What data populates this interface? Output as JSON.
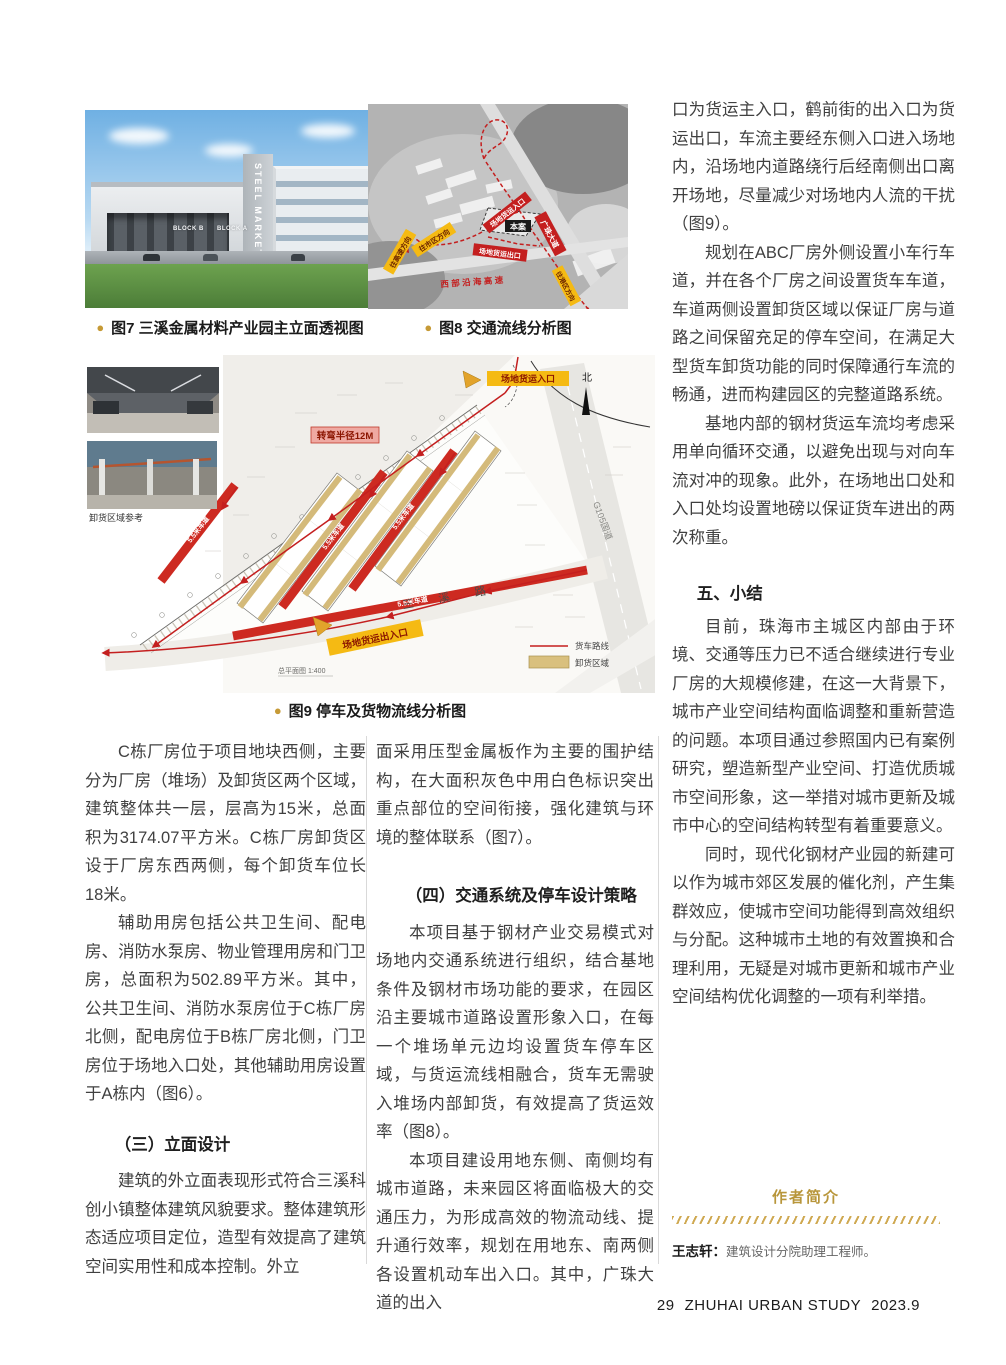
{
  "page": {
    "footer": {
      "page_number": "29",
      "journal_title": "ZHUHAI URBAN STUDY",
      "issue": "2023.9"
    }
  },
  "figures": {
    "fig7": {
      "caption": "图7 三溪金属材料产业园主立面透视图",
      "sign_vertical": "STEEL MARKET",
      "block_a_label": "BLOCK A",
      "block_b_label": "BLOCK B"
    },
    "fig8": {
      "caption": "图8 交通流线分析图",
      "labels": {
        "freight_entrance": "场地货运入口",
        "site": "本案",
        "guangzhu_avenue": "广珠大道",
        "to_city": "往市区方向",
        "to_highway": "往高速方向",
        "freight_exit": "场地货运出口",
        "west_coastal_expressway": "西 部 沿 海 高 速",
        "to_port": "往港区方向"
      }
    },
    "fig9": {
      "caption": "图9 停车及货物流线分析图",
      "photos_caption": "卸货区域参考",
      "labels": {
        "turning_radius": "转弯半径12M",
        "freight_entrance": "场地货运入口",
        "freight_exit_entrance": "场地货运出入口",
        "north": "北",
        "g105": "G105国道",
        "sanxi_road": "三 溪 路",
        "lane": "5.5米车道",
        "scale_note": "总平面图 1:400"
      },
      "legend": {
        "truck_route": "货车路线",
        "unloading_area": "卸货区域"
      }
    }
  },
  "columns": {
    "left": {
      "p1": "C栋厂房位于项目地块西侧，主要分为厂房（堆场）及卸货区两个区域，建筑整体共一层，层高为15米，总面积为3174.07平方米。C栋厂房卸货区设于厂房东西两侧，每个卸货车位长18米。",
      "p2": "辅助用房包括公共卫生间、配电房、消防水泵房、物业管理用房和门卫房，总面积为502.89平方米。其中，公共卫生间、消防水泵房位于C栋厂房北侧，配电房位于B栋厂房北侧，门卫房位于场地入口处，其他辅助用房设置于A栋内（图6）。",
      "h1": "（三）立面设计",
      "p3": "建筑的外立面表现形式符合三溪科创小镇整体建筑风貌要求。整体建筑形态适应项目定位，造型有效提高了建筑空间实用性和成本控制。外立"
    },
    "middle": {
      "p1": "面采用压型金属板作为主要的围护结构，在大面积灰色中用白色标识突出重点部位的空间衔接，强化建筑与环境的整体联系（图7）。",
      "h1": "（四）交通系统及停车设计策略",
      "p2": "本项目基于钢材产业交易模式对场地内交通系统进行组织，结合基地条件及钢材市场功能的要求，在园区沿主要城市道路设置形象入口，在每一个堆场单元边均设置货车停车区域，与货运流线相融合，货车无需驶入堆场内部卸货，有效提高了货运效率（图8）。",
      "p3": "本项目建设用地东侧、南侧均有城市道路，未来园区将面临极大的交通压力，为形成高效的物流动线、提升通行效率，规划在用地东、南两侧各设置机动车出入口。其中，广珠大道的出入"
    },
    "right": {
      "p1": "口为货运主入口，鹤前街的出入口为货运出口，车流主要经东侧入口进入场地内，沿场地内道路绕行后经南侧出口离开场地，尽量减少对场地内人流的干扰（图9）。",
      "p2": "规划在ABC厂房外侧设置小车行车道，并在各个厂房之间设置货车车道，车道两侧设置卸货区域以保证厂房与道路之间保留充足的停车空间，在满足大型货车卸货功能的同时保障通行车流的畅通，进而构建园区的完整道路系统。",
      "p3": "基地内部的钢材货运车流均考虑采用单向循环交通，以避免出现与对向车流对冲的现象。此外，在场地出口处和入口处均设置地磅以保证货车进出的两次称重。",
      "h1": "五、小结",
      "p4": "目前，珠海市主城区内部由于环境、交通等压力已不适合继续进行专业厂房的大规模修建，在这一大背景下，城市产业空间结构面临调整和重新营造的问题。本项目通过参照国内已有案例研究，塑造新型产业空间、打造优质城市空间形象，这一举措对城市更新及城市中心的空间结构转型有着重要意义。",
      "p5": "同时，现代化钢材产业园的新建可以作为城市郊区发展的催化剂，产生集群效应，使城市空间功能得到高效组织与分配。这种城市土地的有效置换和合理利用，无疑是对城市更新和城市产业空间结构优化调整的一项有利举措。"
    }
  },
  "author": {
    "heading": "作者简介",
    "name": "王志轩：",
    "bio": "建筑设计分院助理工程师。"
  },
  "colors": {
    "gold": "#c69a36",
    "red": "#c41f1f",
    "yellow": "#f5ba13",
    "tan": "#d9c07e"
  }
}
